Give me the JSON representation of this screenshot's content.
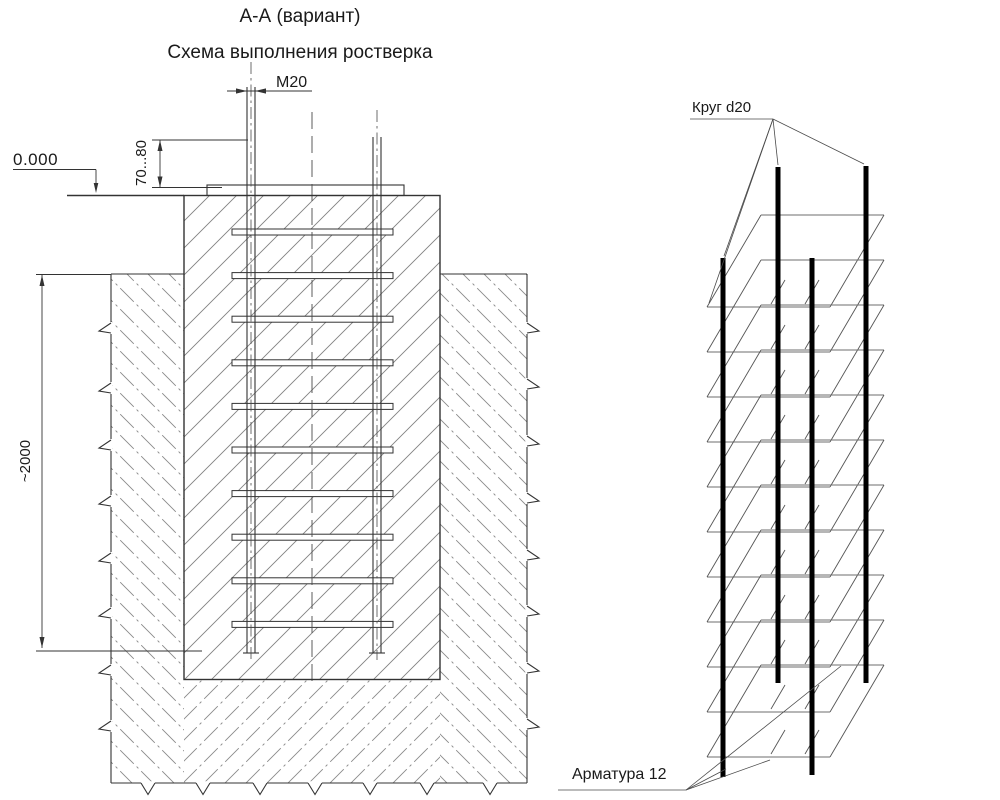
{
  "header": {
    "section_title": "А-А (вариант)",
    "subtitle": "Схема выполнения ростверка"
  },
  "section_view": {
    "dim_bolt": "М20",
    "elevation": "0.000",
    "dim_protrusion": "70...80",
    "dim_depth": "~2000"
  },
  "iso_view": {
    "label_circle": "Круг d20",
    "label_rebar": "Арматура 12"
  },
  "colors": {
    "line": "#333333",
    "concrete_hatch": "#828282",
    "soil_hatch": "#8a8a8a",
    "rebar_bar": "#000000",
    "text": "#1a1a1a",
    "background": "#ffffff"
  }
}
